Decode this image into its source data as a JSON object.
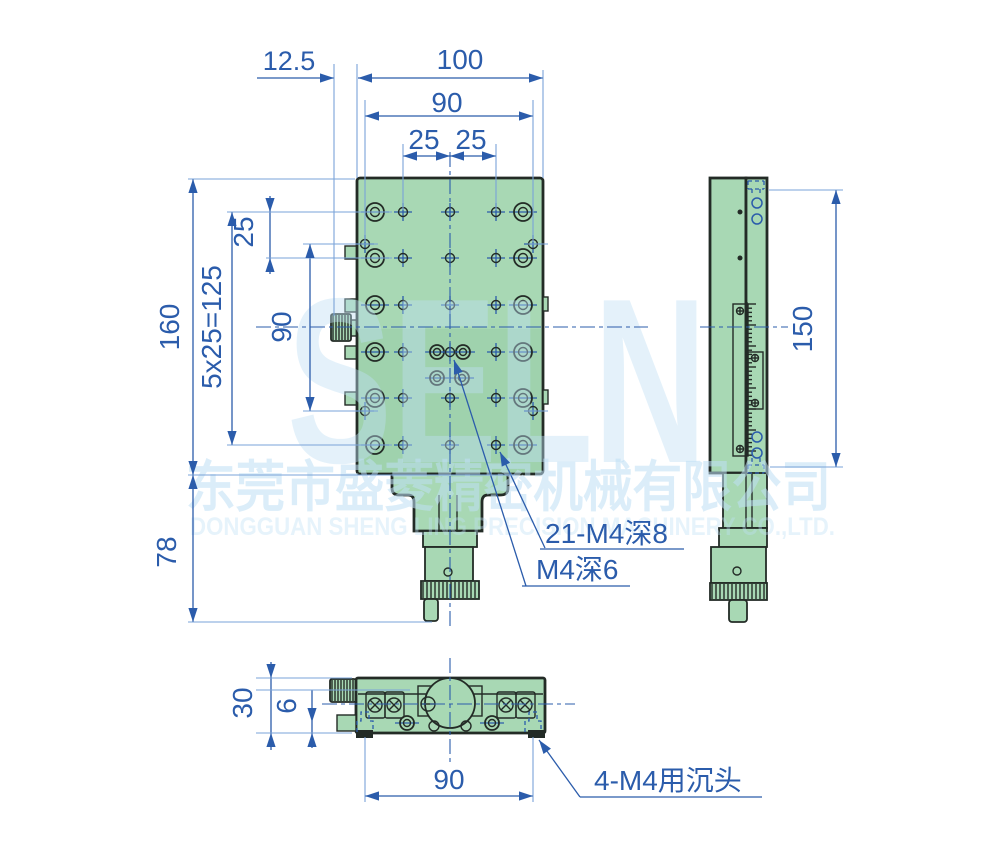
{
  "drawing": {
    "type": "engineering-drawing",
    "views": [
      "front",
      "side",
      "bottom"
    ]
  },
  "colors": {
    "bg": "#ffffff",
    "part": "#a8d8b4",
    "outline": "#232b26",
    "blue": "#2b5cab",
    "ext": "#7aa3d8",
    "wm": "#bfe0f5"
  },
  "watermark": {
    "logo": "SELN",
    "company_cn": "东莞市盛菱精密机械有限公司",
    "company_en": "DONGGUAN SHENG LING PRECISION MACHINERY CO.,LTD."
  },
  "dimensions": {
    "top_offset": "12.5",
    "top_overall": "100",
    "top_inner": "90",
    "top_pitch_left": "25",
    "top_pitch_right": "25",
    "left_overall": "160",
    "left_pitch_total": "5x25=125",
    "left_pitch": "25",
    "left_inner": "90",
    "left_lower": "78",
    "side_height": "150",
    "bottom_height": "30",
    "bottom_step": "6",
    "bottom_width": "90"
  },
  "labels": {
    "holes_grid": "21-M4深8",
    "hole_center": "M4深6",
    "holes_countersunk": "4-M4用沉头"
  }
}
